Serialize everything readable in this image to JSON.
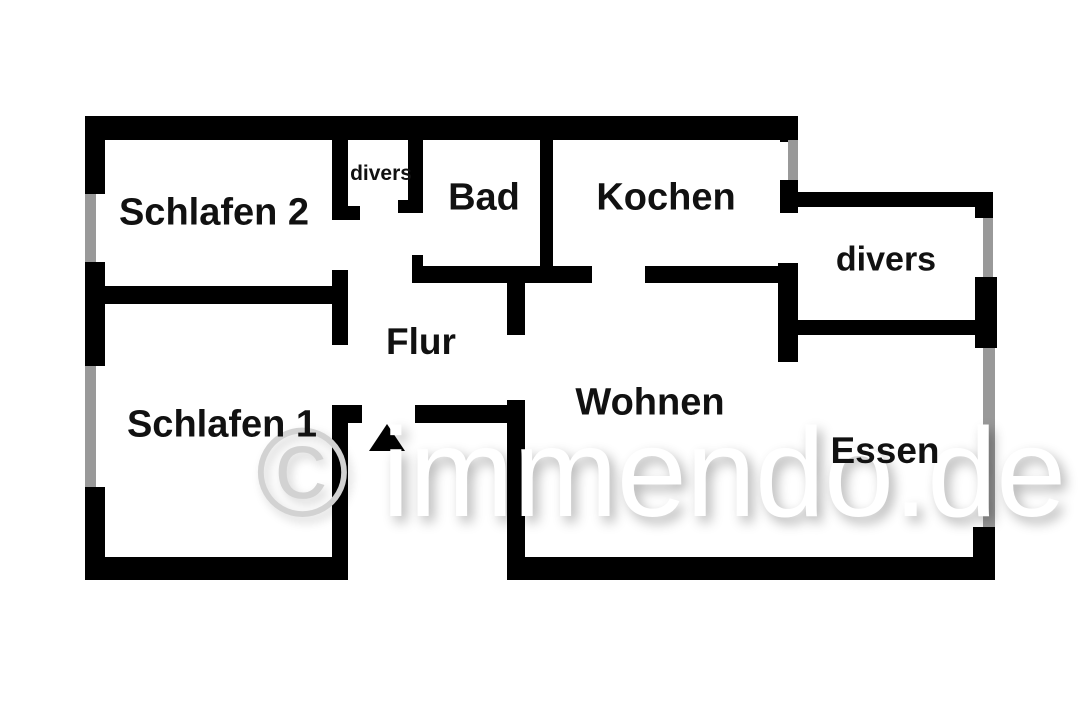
{
  "colors": {
    "wall": "#000000",
    "window": "#999999",
    "label": "#111111",
    "watermark_symbol": "#d2d2d2",
    "watermark_text": "#ffffff",
    "background": "#ffffff"
  },
  "watermark": {
    "symbol": "©",
    "text": " immendo.de"
  },
  "floorplan": {
    "rooms": [
      {
        "id": "schlafen-2",
        "label": "Schlafen 2",
        "cx": 214,
        "cy": 213,
        "size": 38
      },
      {
        "id": "divers-closet",
        "label": "divers",
        "cx": 381,
        "cy": 174,
        "size": 21
      },
      {
        "id": "bad",
        "label": "Bad",
        "cx": 484,
        "cy": 198,
        "size": 38
      },
      {
        "id": "kochen",
        "label": "Kochen",
        "cx": 666,
        "cy": 198,
        "size": 38
      },
      {
        "id": "divers-room",
        "label": "divers",
        "cx": 886,
        "cy": 260,
        "size": 34
      },
      {
        "id": "flur",
        "label": "Flur",
        "cx": 421,
        "cy": 342,
        "size": 37
      },
      {
        "id": "schlafen-1",
        "label": "Schlafen 1",
        "cx": 222,
        "cy": 425,
        "size": 38
      },
      {
        "id": "wohnen",
        "label": "Wohnen",
        "cx": 650,
        "cy": 403,
        "size": 38
      },
      {
        "id": "essen",
        "label": "Essen",
        "cx": 885,
        "cy": 451,
        "size": 37
      }
    ],
    "walls": [
      {
        "name": "outer-top-wall",
        "kind": "solid",
        "x": 85,
        "y": 116,
        "w": 713,
        "h": 24
      },
      {
        "name": "outer-left-wall-upper",
        "kind": "solid",
        "x": 85,
        "y": 116,
        "w": 20,
        "h": 78
      },
      {
        "name": "window-schlafen2",
        "kind": "window",
        "x": 85,
        "y": 194,
        "w": 11,
        "h": 68
      },
      {
        "name": "outer-left-wall-middle",
        "kind": "solid",
        "x": 85,
        "y": 262,
        "w": 20,
        "h": 104
      },
      {
        "name": "window-schlafen1",
        "kind": "window",
        "x": 85,
        "y": 366,
        "w": 11,
        "h": 121
      },
      {
        "name": "outer-left-wall-lower",
        "kind": "solid",
        "x": 85,
        "y": 487,
        "w": 20,
        "h": 93
      },
      {
        "name": "outer-bottom-wall-left",
        "kind": "solid",
        "x": 85,
        "y": 557,
        "w": 260,
        "h": 23
      },
      {
        "name": "schlafen-divider-wall",
        "kind": "solid",
        "x": 85,
        "y": 286,
        "w": 263,
        "h": 18
      },
      {
        "name": "flur-left-wall-upper",
        "kind": "solid",
        "x": 332,
        "y": 140,
        "w": 16,
        "h": 80
      },
      {
        "name": "closet-left-door-stub",
        "kind": "solid",
        "x": 332,
        "y": 206,
        "w": 28,
        "h": 14
      },
      {
        "name": "flur-left-wall-middle",
        "kind": "solid",
        "x": 332,
        "y": 270,
        "w": 16,
        "h": 75
      },
      {
        "name": "flur-left-wall-lower",
        "kind": "solid",
        "x": 332,
        "y": 405,
        "w": 16,
        "h": 175
      },
      {
        "name": "entry-left-door-stub",
        "kind": "solid",
        "x": 332,
        "y": 405,
        "w": 30,
        "h": 18
      },
      {
        "name": "closet-right-wall",
        "kind": "solid",
        "x": 408,
        "y": 140,
        "w": 15,
        "h": 73
      },
      {
        "name": "closet-right-door-stub",
        "kind": "solid",
        "x": 398,
        "y": 200,
        "w": 25,
        "h": 13
      },
      {
        "name": "bad-door-jamb",
        "kind": "solid",
        "x": 412,
        "y": 255,
        "w": 11,
        "h": 28
      },
      {
        "name": "bad-bottom-wall",
        "kind": "solid",
        "x": 412,
        "y": 266,
        "w": 180,
        "h": 17
      },
      {
        "name": "bad-kochen-divider-wall",
        "kind": "solid",
        "x": 540,
        "y": 140,
        "w": 13,
        "h": 128
      },
      {
        "name": "kochen-bottom-wall",
        "kind": "solid",
        "x": 645,
        "y": 266,
        "w": 135,
        "h": 17
      },
      {
        "name": "outer-right-wall-corner",
        "kind": "solid",
        "x": 780,
        "y": 116,
        "w": 18,
        "h": 26
      },
      {
        "name": "window-kochen",
        "kind": "window",
        "x": 788,
        "y": 140,
        "w": 10,
        "h": 40
      },
      {
        "name": "outer-right-wall-mid",
        "kind": "solid",
        "x": 780,
        "y": 180,
        "w": 18,
        "h": 33
      },
      {
        "name": "right-wall-block",
        "kind": "solid",
        "x": 778,
        "y": 263,
        "w": 20,
        "h": 99
      },
      {
        "name": "divers-top-wall",
        "kind": "solid",
        "x": 797,
        "y": 192,
        "w": 196,
        "h": 15
      },
      {
        "name": "divers-right-corner",
        "kind": "solid",
        "x": 975,
        "y": 192,
        "w": 18,
        "h": 26
      },
      {
        "name": "window-divers",
        "kind": "window",
        "x": 983,
        "y": 218,
        "w": 10,
        "h": 59
      },
      {
        "name": "divers-right-block",
        "kind": "solid",
        "x": 975,
        "y": 277,
        "w": 22,
        "h": 71
      },
      {
        "name": "divers-bottom-wall",
        "kind": "solid",
        "x": 797,
        "y": 320,
        "w": 178,
        "h": 15
      },
      {
        "name": "window-essen",
        "kind": "window",
        "x": 983,
        "y": 348,
        "w": 12,
        "h": 179
      },
      {
        "name": "essen-bottom-corner",
        "kind": "solid",
        "x": 973,
        "y": 527,
        "w": 22,
        "h": 53
      },
      {
        "name": "outer-bottom-wall-right",
        "kind": "solid",
        "x": 512,
        "y": 557,
        "w": 483,
        "h": 23
      },
      {
        "name": "wohnen-left-wall-upper",
        "kind": "solid",
        "x": 507,
        "y": 283,
        "w": 18,
        "h": 52
      },
      {
        "name": "wohnen-left-wall-lower",
        "kind": "solid",
        "x": 507,
        "y": 400,
        "w": 18,
        "h": 180
      },
      {
        "name": "flur-bottom-wall",
        "kind": "solid",
        "x": 415,
        "y": 405,
        "w": 95,
        "h": 18
      }
    ],
    "north_arrow": {
      "x": 369,
      "y": 424
    }
  }
}
